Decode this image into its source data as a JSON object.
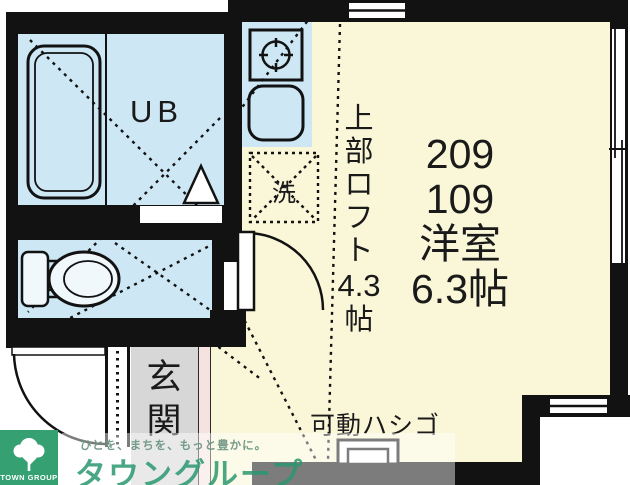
{
  "floorplan": {
    "bath_label": "UB",
    "washer_label": "洗",
    "room_labels": [
      "209",
      "109",
      "洋室",
      "6.3帖"
    ],
    "loft_label": [
      "上",
      "部",
      "ロ",
      "フ",
      "ト",
      "4.3",
      "帖"
    ],
    "entrance_label": [
      "玄",
      "関"
    ],
    "ladder_label": "可動ハシゴ"
  },
  "branding": {
    "logo_text": "TOWN GROUP",
    "tagline": "ひとを、まちを、もっと豊かに。",
    "company_name": "タウングループ"
  },
  "colors": {
    "wall": "#121212",
    "water_area": "#cde7f5",
    "floor": "#faf6d8",
    "entrance_floor": "#d7d7d7",
    "step_edge": "#f6e3e1",
    "brand_green": "#35a173"
  }
}
